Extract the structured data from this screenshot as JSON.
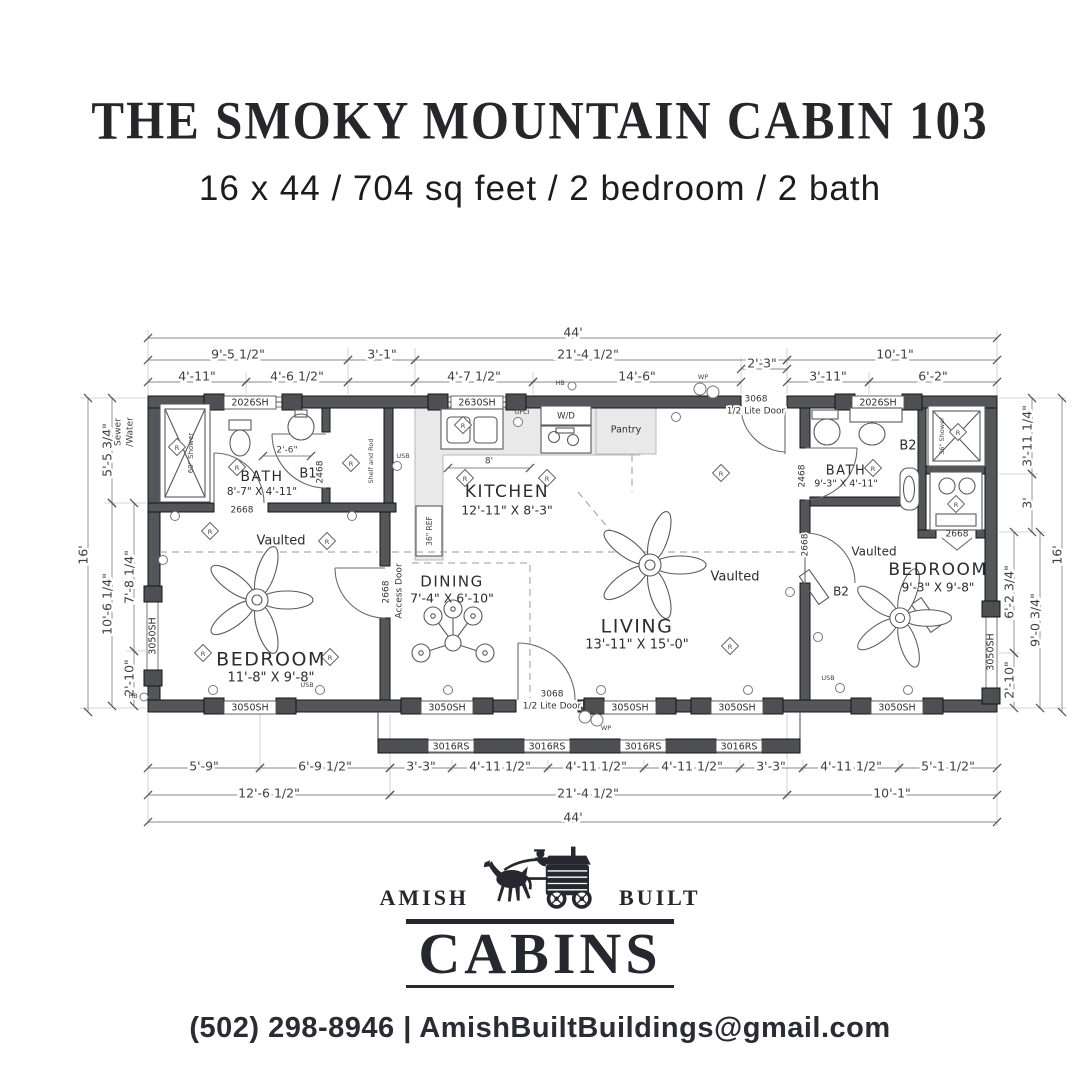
{
  "header": {
    "title": "THE SMOKY MOUNTAIN CABIN 103",
    "subtitle": "16 x 44 / 704 sq feet / 2 bedroom / 2 bath"
  },
  "plan": {
    "dims": {
      "w44": "44'",
      "d16": "16'",
      "a1": "9'-5 1/2\"",
      "a2": "3'-1\"",
      "a3": "21'-4 1/2\"",
      "a4": "10'-1\"",
      "a5": "2'-3\"",
      "b1": "4'-11\"",
      "b2": "4'-6 1/2\"",
      "b3": "4'-7 1/2\"",
      "b4": "14'-6\"",
      "b5": "3'-11\"",
      "b6": "6'-2\"",
      "c1": "5'-9\"",
      "c2": "6'-9 1/2\"",
      "c3": "3'-3\"",
      "c4": "4'-11 1/2\"",
      "c5": "5'-1 1/2\"",
      "c6": "12'-6 1/2\"",
      "l1": "5'-5 3/4\"",
      "l2": "10'-6 1/4\"",
      "l3": "7'-8 1/4\"",
      "l4": "2'-10\"",
      "r1": "3'-11 1/4\"",
      "r2": "3'",
      "r3": "6'-2 3/4\"",
      "r4": "9'-0 3/4\"",
      "k8": "8'",
      "k410": "4'-10 1/4\"",
      "k26": "2'-6\""
    },
    "windows": {
      "w2026": "2026SH",
      "w2630": "2630SH",
      "w3050": "3050SH",
      "w3016": "3016RS"
    },
    "doors": {
      "n3068": "3068",
      "lite": "1/2 Lite Door",
      "n2468": "2468",
      "n2668": "2668",
      "access": "Access Door"
    },
    "rooms": {
      "bath1": {
        "name": "BATH",
        "size": "8'-7\" X 4'-11\""
      },
      "bath2": {
        "name": "BATH",
        "size": "9'-3\" X 4'-11\""
      },
      "kitchen": {
        "name": "KITCHEN",
        "size": "12'-11\" X 8'-3\""
      },
      "dining": {
        "name": "DINING",
        "size": "7'-4\" X 6'-10\""
      },
      "living": {
        "name": "LIVING",
        "size": "13'-11\" X 15'-0\""
      },
      "bed1": {
        "name": "BEDROOM",
        "size": "11'-8\" X 9'-8\""
      },
      "bed2": {
        "name": "BEDROOM",
        "size": "9'-3\" X 9'-8\""
      }
    },
    "labels": {
      "b1": "B1",
      "b2": "B2",
      "vaulted": "Vaulted",
      "pantry": "Pantry",
      "wd": "W/D",
      "ref": "36\" REF",
      "shower60": "60\" Shower",
      "shower36": "36\" Shower",
      "shelf": "Shelf and Rod",
      "sewer": "Sewer",
      "water": "/Water",
      "gfci": "GFCI",
      "usb": "USB",
      "wp": "WP",
      "hb": "HB",
      "r": "R"
    }
  },
  "footer": {
    "brand_left": "AMISH",
    "brand_right": "BUILT",
    "brand_main": "CABINS",
    "contact": "(502) 298-8946 | AmishBuiltBuildings@gmail.com"
  }
}
